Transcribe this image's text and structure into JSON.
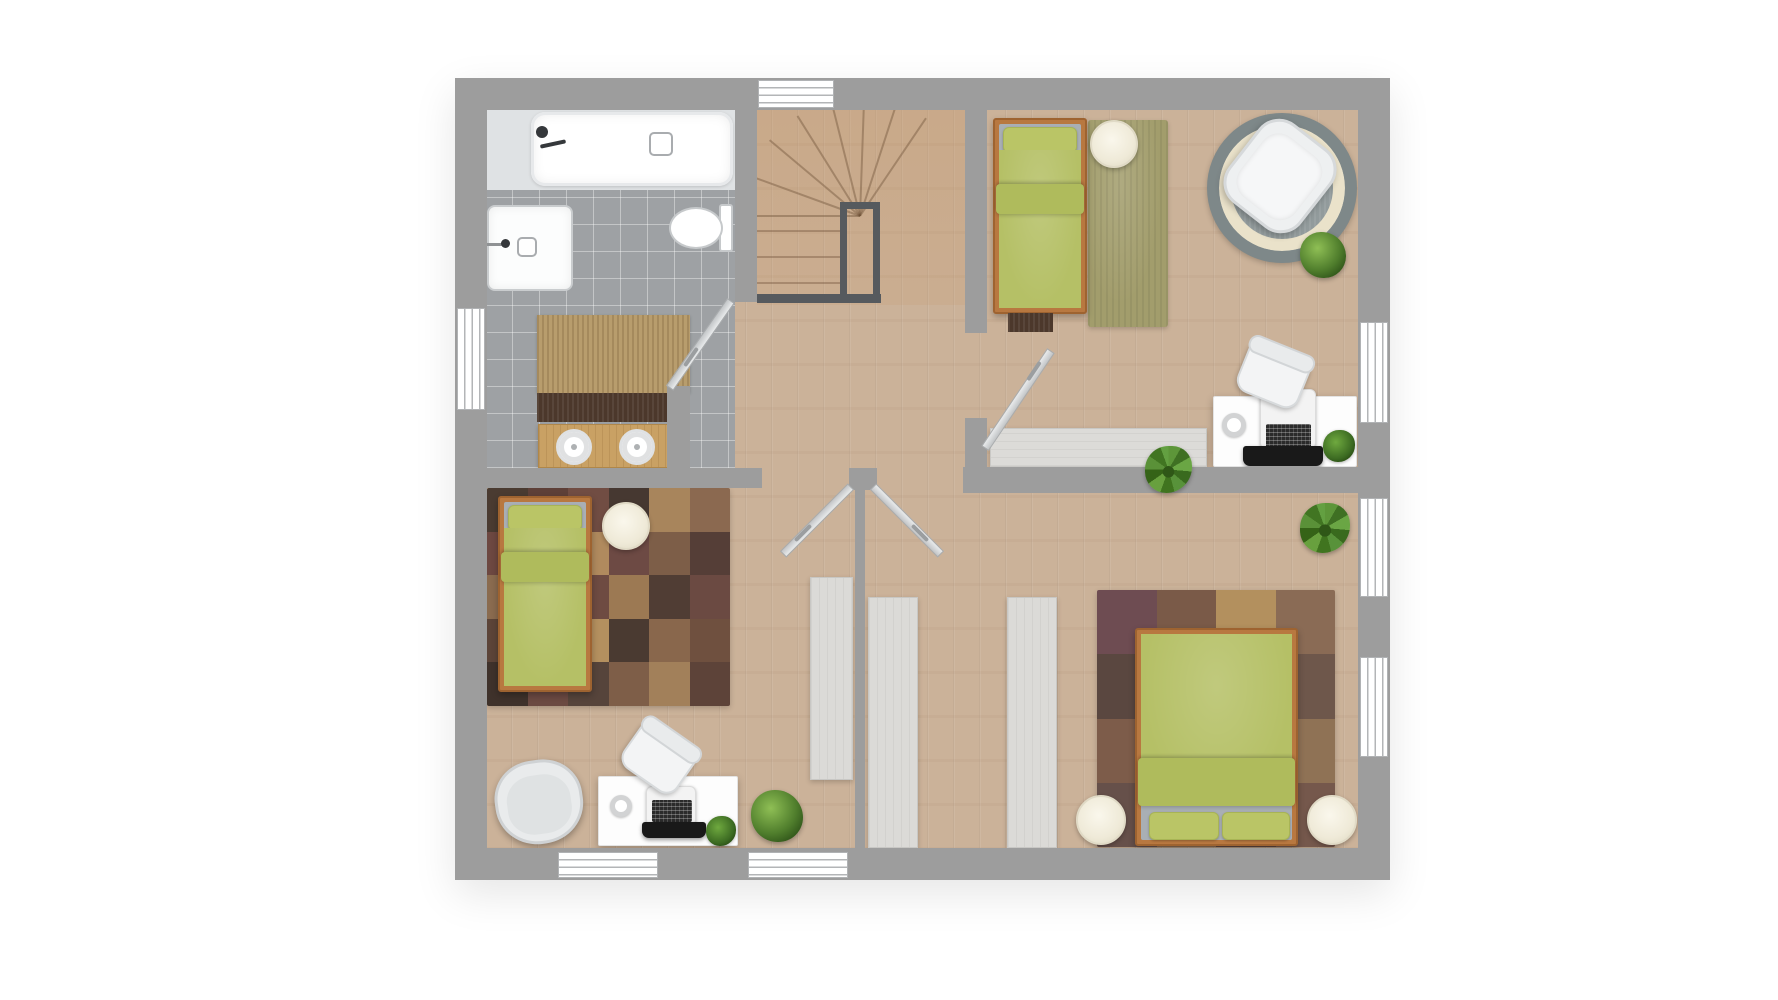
{
  "meta": {
    "label": "Upper floor plan with bathroom, staircase and three bedrooms",
    "canvas": {
      "w": 1778,
      "h": 1000
    }
  },
  "palette": {
    "wall": "#9d9d9d",
    "wood_floor": "#cbb299",
    "tile_floor": "#9ea1a4",
    "bedding_green": "#b5c066",
    "bed_frame_wood": "#b87840",
    "railing_dark": "#565a5e",
    "wardrobe_gray": "#dbdad7",
    "rug_olive": "#a29d6c",
    "rug_round_ring": "#eae2ca",
    "pouf_cream": "#f3efe2",
    "vanity_wood": "#c9a164",
    "white_fixture": "#ffffff"
  },
  "elements": [
    {
      "n": "plan-outline",
      "cls": "plan-shadow",
      "x": 455,
      "y": 78,
      "w": 935,
      "h": 802
    },
    {
      "n": "wood-floor",
      "cls": "wood",
      "x": 485,
      "y": 108,
      "w": 875,
      "h": 742
    },
    {
      "n": "stairs-floor",
      "cls": "stairs-tint",
      "x": 757,
      "y": 108,
      "w": 208,
      "h": 197
    },
    {
      "n": "bathroom-tile-floor",
      "cls": "tile",
      "x": 485,
      "y": 108,
      "w": 250,
      "h": 360
    },
    {
      "n": "stair-fan-line-1",
      "cls": "fanline",
      "x": 860,
      "y": 215,
      "w": 118,
      "h": 2,
      "rot": 180,
      "org": "0 50%"
    },
    {
      "n": "stair-fan-line-2",
      "cls": "fanline",
      "x": 860,
      "y": 215,
      "w": 118,
      "h": 2,
      "rot": -160,
      "org": "0 50%"
    },
    {
      "n": "stair-fan-line-3",
      "cls": "fanline",
      "x": 860,
      "y": 215,
      "w": 118,
      "h": 2,
      "rot": -140,
      "org": "0 50%"
    },
    {
      "n": "stair-fan-line-4",
      "cls": "fanline",
      "x": 860,
      "y": 215,
      "w": 118,
      "h": 2,
      "rot": -122,
      "org": "0 50%"
    },
    {
      "n": "stair-fan-line-5",
      "cls": "fanline",
      "x": 860,
      "y": 215,
      "w": 118,
      "h": 2,
      "rot": -104,
      "org": "0 50%"
    },
    {
      "n": "stair-fan-line-6",
      "cls": "fanline",
      "x": 860,
      "y": 215,
      "w": 118,
      "h": 2,
      "rot": -88,
      "org": "0 50%"
    },
    {
      "n": "stair-fan-line-7",
      "cls": "fanline",
      "x": 860,
      "y": 215,
      "w": 118,
      "h": 2,
      "rot": -72,
      "org": "0 50%"
    },
    {
      "n": "stair-fan-line-8",
      "cls": "fanline",
      "x": 860,
      "y": 215,
      "w": 118,
      "h": 2,
      "rot": -56,
      "org": "0 50%"
    },
    {
      "n": "stair-tread-1",
      "cls": "tread",
      "x": 757,
      "y": 230,
      "w": 86,
      "h": 2
    },
    {
      "n": "stair-tread-2",
      "cls": "tread",
      "x": 757,
      "y": 256,
      "w": 86,
      "h": 2
    },
    {
      "n": "stair-tread-3",
      "cls": "tread",
      "x": 757,
      "y": 282,
      "w": 86,
      "h": 2
    },
    {
      "n": "stair-railing",
      "cls": "railing",
      "x": 840,
      "y": 202,
      "w": 40,
      "h": 101
    },
    {
      "n": "stair-rail-bottom",
      "cls": "railbar",
      "x": 757,
      "y": 294,
      "w": 124,
      "h": 9
    },
    {
      "n": "bedroom1-olive-rug",
      "cls": "rug-olive",
      "x": 1088,
      "y": 120,
      "w": 80,
      "h": 207
    },
    {
      "n": "bedroom1-round-rug",
      "cls": "rug-round",
      "x": 1207,
      "y": 113,
      "w": 150,
      "h": 150
    },
    {
      "n": "bedroom2-patch-rug",
      "cls": "patches",
      "x": 487,
      "y": 488,
      "w": 243,
      "h": 218,
      "cols": 6,
      "pal": [
        "#4a3b31",
        "#5e4038",
        "#714d43",
        "#463831",
        "#a8855c",
        "#8b6950",
        "#6d4841",
        "#524039",
        "#b08a5e",
        "#6d4a44",
        "#7d5e48",
        "#553e37",
        "#8a6b4f",
        "#42332c",
        "#6e4b42",
        "#9c7953",
        "#503d34",
        "#6b4a42",
        "#5c4438",
        "#7b5a46",
        "#b4905f",
        "#4a3a31",
        "#89674c",
        "#6f503f",
        "#3f322b",
        "#6b4a42",
        "#56443b",
        "#7e5e48",
        "#a2805a",
        "#5d4339"
      ]
    },
    {
      "n": "bedroom3-patch-rug",
      "cls": "patches",
      "x": 1097,
      "y": 590,
      "w": 238,
      "h": 257,
      "cols": 4,
      "pal": [
        "#6e4c52",
        "#7a5a48",
        "#b3905e",
        "#8a6b55",
        "#5a4740",
        "#6b4a50",
        "#997a58",
        "#6e574b",
        "#7d5c4a",
        "#523f3a",
        "#6b4a44",
        "#8f7255",
        "#66504a",
        "#8a6a50",
        "#5e463e",
        "#75584c"
      ]
    },
    {
      "n": "bathroom-rug",
      "cls": "rug-tan",
      "x": 537,
      "y": 315,
      "w": 153,
      "h": 78
    },
    {
      "n": "bathroom-mat",
      "cls": "rug-dark",
      "x": 537,
      "y": 393,
      "w": 153,
      "h": 29
    },
    {
      "n": "wardrobe-bedroom2",
      "cls": "wardrobe",
      "x": 810,
      "y": 577,
      "w": 43,
      "h": 203
    },
    {
      "n": "wardrobe-bedroom3-a",
      "cls": "wardrobe",
      "x": 868,
      "y": 597,
      "w": 50,
      "h": 251
    },
    {
      "n": "wardrobe-bedroom3-b",
      "cls": "wardrobe",
      "x": 1007,
      "y": 597,
      "w": 50,
      "h": 251
    },
    {
      "n": "sideboard-bedroom1",
      "cls": "wardrobe-h",
      "x": 990,
      "y": 428,
      "w": 217,
      "h": 39
    },
    {
      "n": "bathtub-deck",
      "cls": "deck",
      "x": 487,
      "y": 108,
      "w": 248,
      "h": 82
    },
    {
      "n": "bathtub",
      "cls": "tub",
      "x": 531,
      "y": 112,
      "w": 202,
      "h": 74
    },
    {
      "n": "bathtub-faucet-icon",
      "cls": "dark-dot",
      "x": 536,
      "y": 126,
      "w": 12,
      "h": 12
    },
    {
      "n": "bathtub-faucet-stem-icon",
      "cls": "dark-bar",
      "x": 540,
      "y": 142,
      "w": 26,
      "h": 4,
      "rot": -12
    },
    {
      "n": "bathtub-drain",
      "cls": "drain",
      "x": 649,
      "y": 132,
      "w": 24,
      "h": 24
    },
    {
      "n": "shower",
      "cls": "shower",
      "x": 487,
      "y": 205,
      "w": 86,
      "h": 86
    },
    {
      "n": "shower-drain",
      "cls": "drain",
      "x": 517,
      "y": 237,
      "w": 20,
      "h": 20
    },
    {
      "n": "shower-faucet-stem-icon",
      "cls": "gray-bar",
      "x": 487,
      "y": 243,
      "w": 18,
      "h": 3
    },
    {
      "n": "shower-faucet-icon",
      "cls": "dark-dot",
      "x": 501,
      "y": 239,
      "w": 9,
      "h": 9
    },
    {
      "n": "toilet-tank",
      "cls": "toilet-t",
      "x": 719,
      "y": 204,
      "w": 14,
      "h": 48
    },
    {
      "n": "toilet-bowl",
      "cls": "toilet-b",
      "x": 669,
      "y": 207,
      "w": 54,
      "h": 42
    },
    {
      "n": "vanity-counter",
      "cls": "wood-counter",
      "x": 538,
      "y": 424,
      "w": 134,
      "h": 44
    },
    {
      "n": "vanity-sink-left",
      "cls": "sink",
      "x": 556,
      "y": 429,
      "w": 36,
      "h": 36
    },
    {
      "n": "vanity-sink-right",
      "cls": "sink",
      "x": 619,
      "y": 429,
      "w": 36,
      "h": 36
    },
    {
      "n": "bed1-frame",
      "cls": "bedframe",
      "x": 993,
      "y": 118,
      "w": 94,
      "h": 196
    },
    {
      "n": "bed1-mattress",
      "cls": "mattress",
      "x": 999,
      "y": 124,
      "w": 82,
      "h": 184
    },
    {
      "n": "bed1-pillow",
      "cls": "pillow",
      "x": 1003,
      "y": 127,
      "w": 74,
      "h": 26
    },
    {
      "n": "bed1-duvet",
      "cls": "duvet",
      "x": 999,
      "y": 150,
      "w": 82,
      "h": 158
    },
    {
      "n": "bed1-duvet-fold",
      "cls": "duvet-fold",
      "x": 996,
      "y": 184,
      "w": 88,
      "h": 30
    },
    {
      "n": "bed1-foot-mat",
      "cls": "rug-dark",
      "x": 1008,
      "y": 313,
      "w": 45,
      "h": 19
    },
    {
      "n": "bed2-frame",
      "cls": "bedframe",
      "x": 498,
      "y": 496,
      "w": 94,
      "h": 196
    },
    {
      "n": "bed2-mattress",
      "cls": "mattress",
      "x": 504,
      "y": 502,
      "w": 82,
      "h": 184
    },
    {
      "n": "bed2-pillow",
      "cls": "pillow",
      "x": 508,
      "y": 505,
      "w": 74,
      "h": 26
    },
    {
      "n": "bed2-duvet",
      "cls": "duvet",
      "x": 504,
      "y": 528,
      "w": 82,
      "h": 158
    },
    {
      "n": "bed2-duvet-fold",
      "cls": "duvet-fold",
      "x": 501,
      "y": 552,
      "w": 88,
      "h": 30
    },
    {
      "n": "bed3-frame",
      "cls": "bedframe",
      "x": 1135,
      "y": 628,
      "w": 163,
      "h": 218
    },
    {
      "n": "bed3-mattress",
      "cls": "mattress",
      "x": 1141,
      "y": 634,
      "w": 151,
      "h": 206
    },
    {
      "n": "bed3-duvet",
      "cls": "duvet",
      "x": 1141,
      "y": 634,
      "w": 151,
      "h": 172
    },
    {
      "n": "bed3-duvet-fold",
      "cls": "duvet-fold",
      "x": 1138,
      "y": 758,
      "w": 157,
      "h": 48
    },
    {
      "n": "bed3-pillow-left",
      "cls": "pillow",
      "x": 1149,
      "y": 812,
      "w": 70,
      "h": 28
    },
    {
      "n": "bed3-pillow-right",
      "cls": "pillow",
      "x": 1222,
      "y": 812,
      "w": 68,
      "h": 28
    },
    {
      "n": "pouf-bedroom1",
      "cls": "pouf",
      "x": 1090,
      "y": 120,
      "w": 48,
      "h": 48
    },
    {
      "n": "pouf-bedroom2",
      "cls": "pouf",
      "x": 602,
      "y": 502,
      "w": 48,
      "h": 48
    },
    {
      "n": "pouf-bedroom3-left",
      "cls": "pouf",
      "x": 1076,
      "y": 795,
      "w": 50,
      "h": 50
    },
    {
      "n": "pouf-bedroom3-right",
      "cls": "pouf",
      "x": 1307,
      "y": 795,
      "w": 50,
      "h": 50
    },
    {
      "n": "desk-bedroom1",
      "cls": "desk",
      "x": 1213,
      "y": 396,
      "w": 144,
      "h": 71
    },
    {
      "n": "laptop1-body",
      "cls": "laptop-body",
      "x": 1260,
      "y": 389,
      "w": 56,
      "h": 60
    },
    {
      "n": "laptop1-keyboard",
      "cls": "keyboard",
      "x": 1266,
      "y": 424,
      "w": 45,
      "h": 24
    },
    {
      "n": "laptop1-base",
      "cls": "laptop-base",
      "x": 1243,
      "y": 446,
      "w": 80,
      "h": 20
    },
    {
      "n": "mug-desk1",
      "cls": "mug",
      "x": 1222,
      "y": 413,
      "w": 24,
      "h": 24
    },
    {
      "n": "plant-desk1",
      "cls": "plant-small",
      "x": 1323,
      "y": 430,
      "w": 32,
      "h": 32
    },
    {
      "n": "desk-bedroom2",
      "cls": "desk",
      "x": 598,
      "y": 776,
      "w": 140,
      "h": 70
    },
    {
      "n": "laptop2-body",
      "cls": "laptop-body",
      "x": 646,
      "y": 786,
      "w": 50,
      "h": 40
    },
    {
      "n": "laptop2-keyboard",
      "cls": "keyboard",
      "x": 652,
      "y": 800,
      "w": 40,
      "h": 22
    },
    {
      "n": "laptop2-base",
      "cls": "laptop-base",
      "x": 642,
      "y": 822,
      "w": 64,
      "h": 16
    },
    {
      "n": "mug-desk2",
      "cls": "mug",
      "x": 610,
      "y": 795,
      "w": 22,
      "h": 22
    },
    {
      "n": "plant-desk2",
      "cls": "plant-small",
      "x": 706,
      "y": 816,
      "w": 30,
      "h": 30
    },
    {
      "n": "chair-round-rug",
      "cls": "tub-chair",
      "x": 1234,
      "y": 126,
      "w": 92,
      "h": 100,
      "rot": 38
    },
    {
      "n": "chair-desk1",
      "cls": "chair-desk",
      "x": 1240,
      "y": 350,
      "w": 66,
      "h": 52,
      "rot": 22
    },
    {
      "n": "chair-desk2",
      "cls": "chair-desk",
      "x": 625,
      "y": 733,
      "w": 66,
      "h": 52,
      "rot": 35
    },
    {
      "n": "armchair-bedroom2",
      "cls": "armchair",
      "x": 495,
      "y": 760,
      "w": 88,
      "h": 84,
      "rot": -8
    },
    {
      "n": "plant-round-rug",
      "cls": "plant",
      "x": 1300,
      "y": 232,
      "w": 46,
      "h": 46
    },
    {
      "n": "plant-bedroom2-floor",
      "cls": "plant",
      "x": 751,
      "y": 790,
      "w": 52,
      "h": 52
    },
    {
      "n": "plant-bedroom3",
      "cls": "plant-aloe",
      "x": 1300,
      "y": 503,
      "w": 50,
      "h": 50
    },
    {
      "n": "wall-top",
      "cls": "wall",
      "x": 455,
      "y": 78,
      "w": 935,
      "h": 32
    },
    {
      "n": "wall-left",
      "cls": "wall",
      "x": 455,
      "y": 78,
      "w": 32,
      "h": 802
    },
    {
      "n": "wall-right",
      "cls": "wall",
      "x": 1358,
      "y": 78,
      "w": 32,
      "h": 802
    },
    {
      "n": "wall-bottom",
      "cls": "wall",
      "x": 455,
      "y": 848,
      "w": 935,
      "h": 32
    },
    {
      "n": "wall-bathroom-east",
      "cls": "wall",
      "x": 735,
      "y": 108,
      "w": 22,
      "h": 194
    },
    {
      "n": "wall-bathroom-door-stub",
      "cls": "wall",
      "x": 667,
      "y": 386,
      "w": 23,
      "h": 84
    },
    {
      "n": "wall-bathroom-south",
      "cls": "wall",
      "x": 455,
      "y": 468,
      "w": 307,
      "h": 20
    },
    {
      "n": "wall-hall-door-stub",
      "cls": "wall",
      "x": 849,
      "y": 468,
      "w": 28,
      "h": 22
    },
    {
      "n": "wall-bedroom3-north",
      "cls": "wall",
      "x": 963,
      "y": 467,
      "w": 427,
      "h": 26
    },
    {
      "n": "wall-bedroom1-west-upper",
      "cls": "wall",
      "x": 965,
      "y": 108,
      "w": 22,
      "h": 225
    },
    {
      "n": "wall-bedroom1-west-lower",
      "cls": "wall",
      "x": 965,
      "y": 418,
      "w": 22,
      "h": 75
    },
    {
      "n": "wall-bedroom-divider",
      "cls": "wall",
      "x": 855,
      "y": 488,
      "w": 10,
      "h": 362
    },
    {
      "n": "window-top",
      "cls": "win-hlines",
      "x": 758,
      "y": 80,
      "w": 76,
      "h": 28
    },
    {
      "n": "window-left",
      "cls": "win-vlines",
      "x": 457,
      "y": 308,
      "w": 28,
      "h": 102
    },
    {
      "n": "window-right-1",
      "cls": "win-vlines",
      "x": 1360,
      "y": 322,
      "w": 28,
      "h": 101
    },
    {
      "n": "window-right-2",
      "cls": "win-vlines",
      "x": 1360,
      "y": 498,
      "w": 28,
      "h": 99
    },
    {
      "n": "window-right-3",
      "cls": "win-vlines",
      "x": 1360,
      "y": 657,
      "w": 28,
      "h": 100
    },
    {
      "n": "window-bottom-1",
      "cls": "win-hlines",
      "x": 558,
      "y": 852,
      "w": 100,
      "h": 26
    },
    {
      "n": "window-bottom-2",
      "cls": "win-hlines",
      "x": 748,
      "y": 852,
      "w": 100,
      "h": 26
    },
    {
      "n": "door-bathroom",
      "cls": "door-bar",
      "x": 731,
      "y": 296,
      "w": 107,
      "h": 9,
      "rot": 125,
      "org": "0 50%"
    },
    {
      "n": "door-bathroom-handle",
      "cls": "door-handle",
      "x": 689,
      "y": 346,
      "w": 4,
      "h": 22,
      "rot": 35
    },
    {
      "n": "door-bedroom1",
      "cls": "door-bar",
      "x": 985,
      "y": 444,
      "w": 118,
      "h": 9,
      "rot": -56,
      "org": "0 50%"
    },
    {
      "n": "door-bedroom1-handle",
      "cls": "door-handle",
      "x": 1032,
      "y": 360,
      "w": 4,
      "h": 22,
      "rot": 34
    },
    {
      "n": "door-bedroom2",
      "cls": "door-bar",
      "x": 851,
      "y": 482,
      "w": 96,
      "h": 9,
      "rot": 135,
      "org": "0 50%"
    },
    {
      "n": "door-bedroom2-handle",
      "cls": "door-handle",
      "x": 801,
      "y": 522,
      "w": 4,
      "h": 22,
      "rot": 45
    },
    {
      "n": "door-bedroom3",
      "cls": "door-bar",
      "x": 873,
      "y": 482,
      "w": 96,
      "h": 9,
      "rot": 45,
      "org": "0 50%"
    },
    {
      "n": "door-bedroom3-handle",
      "cls": "door-handle",
      "x": 918,
      "y": 522,
      "w": 4,
      "h": 22,
      "rot": -45
    },
    {
      "n": "plant-hallway",
      "cls": "plant-aloe",
      "x": 1145,
      "y": 446,
      "w": 47,
      "h": 47
    }
  ]
}
